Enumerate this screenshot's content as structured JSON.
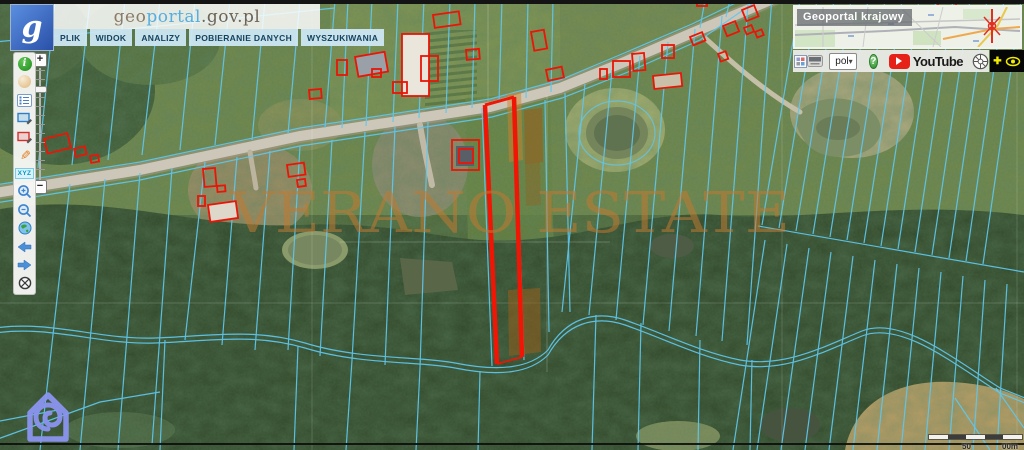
{
  "header": {
    "logo_letter": "g",
    "brand": {
      "geo": "geo",
      "portal": "portal",
      "suffix": ".gov.pl"
    },
    "menu": [
      "PLIK",
      "WIDOK",
      "ANALIZY",
      "POBIERANIE DANYCH",
      "WYSZUKIWANIA"
    ]
  },
  "icons": {
    "info": "i",
    "pencil": "✎",
    "xyz": "XYZ",
    "slider_plus": "+",
    "slider_minus": "−",
    "chevron": "▾",
    "help": "?",
    "contrast_plus": "✚"
  },
  "minimap": {
    "title": "Geoportal krajowy"
  },
  "top_bar": {
    "language": "pol",
    "youtube": "YouTube"
  },
  "watermark": "VERANO ESTATE",
  "scale_bar": {
    "mid": "50",
    "end": "00m"
  },
  "colors": {
    "parcel_line": "#5fc8f0",
    "building_outline": "#ea1507",
    "selected_parcel": "#f01505",
    "accent": "#4a90d9"
  }
}
